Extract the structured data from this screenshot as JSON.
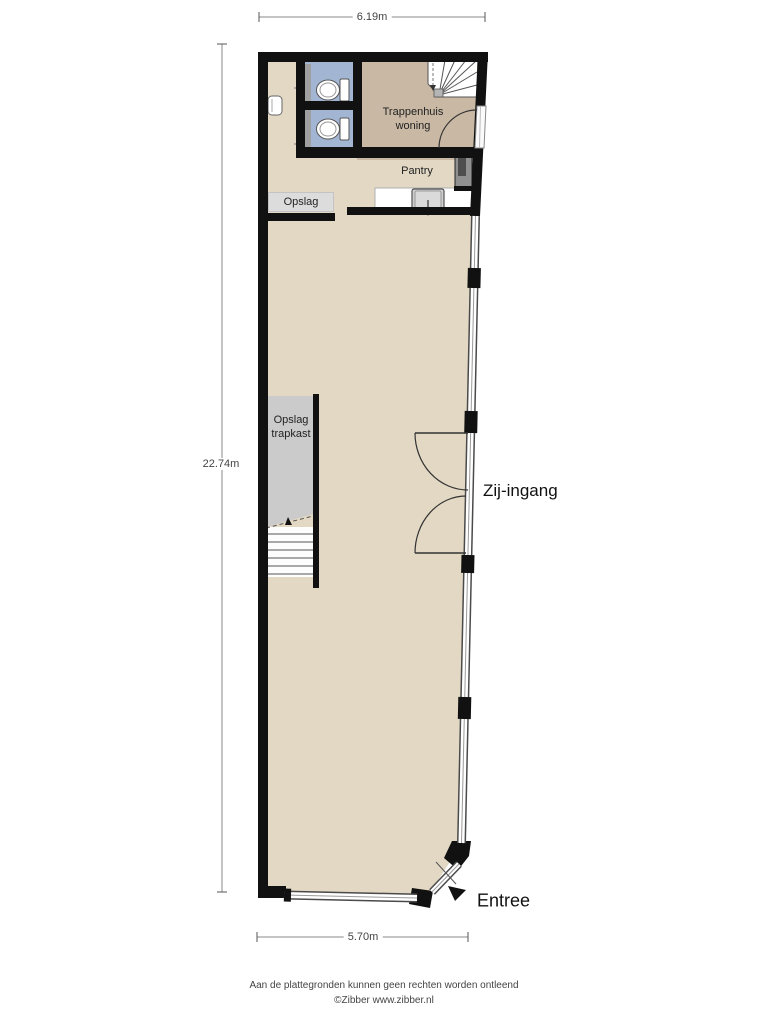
{
  "dimensions": {
    "top": "6.19m",
    "left": "22.74m",
    "bottom": "5.70m"
  },
  "rooms": {
    "trappenhuis": {
      "line1": "Trappenhuis",
      "line2": "woning"
    },
    "pantry": {
      "label": "Pantry"
    },
    "opslag": {
      "label": "Opslag"
    },
    "opslag_trapkast": {
      "line1": "Opslag",
      "line2": "trapkast"
    }
  },
  "entrances": {
    "side_label": "Zij-ingang",
    "main_label": "Entree"
  },
  "footer": {
    "line1": "Aan de plattegronden kunnen geen rechten worden ontleend",
    "line2": "©Zibber www.zibber.nl"
  },
  "colors": {
    "floor": "#e2d8c3",
    "stairwell_floor": "#c8b8a4",
    "wc_floor": "#a2b6d4",
    "storage_floor": "#cbcbcb",
    "wall": "#111111",
    "window_frame": "#4a4a4a"
  },
  "icons": [
    "toilet-icon",
    "basin-icon",
    "sink-icon",
    "boiler-icon",
    "stairs-icon",
    "door-arc-icon",
    "window-icon",
    "entree-arrow-icon"
  ]
}
